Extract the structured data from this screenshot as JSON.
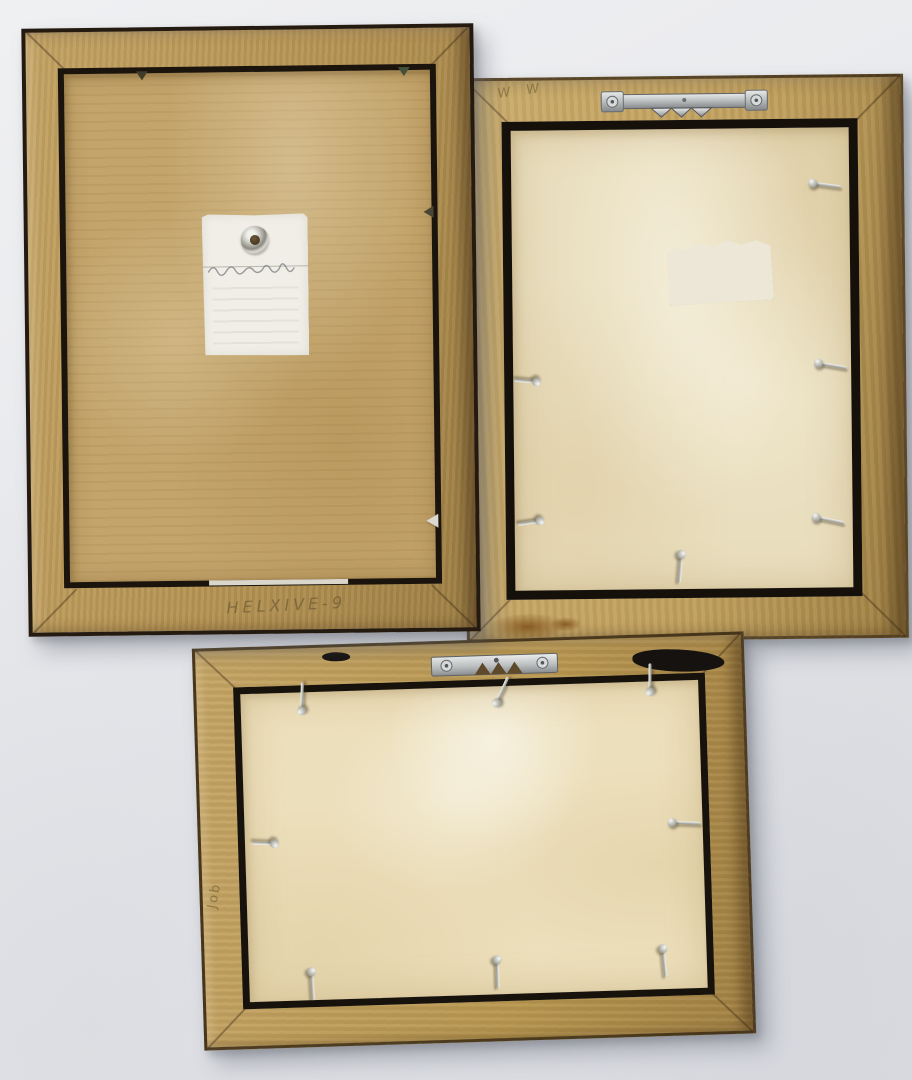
{
  "scene": {
    "description": "Back view of three vintage wooden picture frames photographed against a pale grey wall",
    "wall_color": "#e8e9ec"
  },
  "frames": [
    {
      "name": "large vertical frame",
      "position": "top-left",
      "wood_color": "#b39253",
      "trim_color": "#1a140c",
      "backing_material": "corrugated cardboard",
      "backing_color": "#c3a46a",
      "inscription": "HELXIVE-9",
      "tag": {
        "material": "paper hang tag with metal eyelet",
        "color": "#f0eee6",
        "handwriting": "illegible pencil cursive"
      },
      "hardware": {
        "glazing_points": 4
      }
    },
    {
      "name": "vertical frame",
      "position": "top-right",
      "wood_color": "#bd9d5c",
      "trim_color": "#15100a",
      "backing_material": "paper dust cover",
      "backing_color": "#e9debe",
      "scribble": "W W",
      "label": {
        "material": "blank paper sticker",
        "color": "#ece7d6"
      },
      "hardware": {
        "sawtooth_hanger": 1,
        "nails": 7,
        "stain": "brown stain on bottom rail"
      }
    },
    {
      "name": "horizontal frame",
      "position": "bottom",
      "wood_color": "#b6954f",
      "trim_color": "#17120b",
      "backing_material": "paper dust cover",
      "backing_color": "#ecdfbb",
      "scribble": "Job",
      "hardware": {
        "strap_hanger": 1,
        "nails": 8,
        "chips": "black finish chips on top rail"
      }
    }
  ]
}
